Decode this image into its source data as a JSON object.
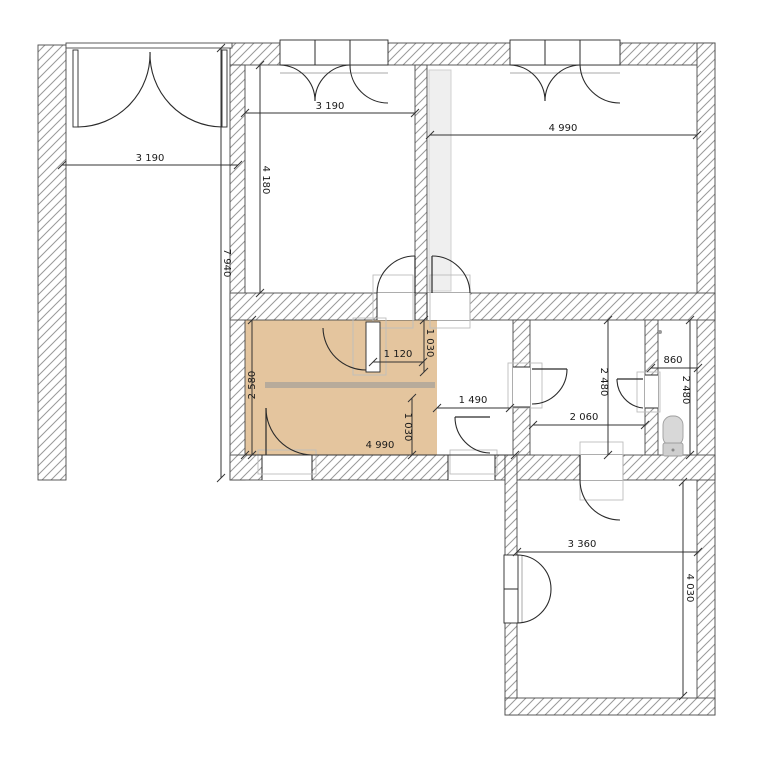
{
  "plan": {
    "canvas": {
      "width": 772,
      "height": 772
    },
    "colors": {
      "background": "#ffffff",
      "wall_border": "#4a4a4a",
      "hatch_line": "#999999",
      "line": "#2b2b2b",
      "highlight": "#e4c59e",
      "shelf": "#b7ab9b",
      "frame_gray": "#bdbdbd",
      "sill_gray": "#aaaaaa",
      "shaft_fill": "#efefef",
      "shaft_border": "#cccccc",
      "fixture_fill": "#d8d8d8",
      "fixture_fill2": "#cfcfcf",
      "fixture_border": "#9e9e9e",
      "dim_line": "#333333",
      "dim_text": "#1a1a1a"
    },
    "highlight_room": {
      "name": "highlighted-room-floor",
      "x": 245,
      "y": 320,
      "w": 192,
      "h": 135
    },
    "shaft": {
      "name": "duct-shaft",
      "x": 429,
      "y": 70,
      "w": 22,
      "h": 221
    },
    "shelf": {
      "name": "shelf-furniture",
      "x": 265,
      "y": 382,
      "w": 170,
      "h": 6
    },
    "walls": [
      {
        "name": "outbuilding-left-wall",
        "x": 38,
        "y": 45,
        "w": 28,
        "h": 435
      },
      {
        "name": "top-wall",
        "x": 230,
        "y": 43,
        "w": 485,
        "h": 22
      },
      {
        "name": "right-wall",
        "x": 697,
        "y": 43,
        "w": 18,
        "h": 672
      },
      {
        "name": "main-left-wall",
        "x": 230,
        "y": 65,
        "w": 15,
        "h": 415
      },
      {
        "name": "top-rooms-partition",
        "x": 415,
        "y": 65,
        "w": 12,
        "h": 228
      },
      {
        "name": "middle-wall",
        "x": 230,
        "y": 293,
        "w": 485,
        "h": 27
      },
      {
        "name": "hall-bath-wall",
        "x": 513,
        "y": 320,
        "w": 17,
        "h": 135
      },
      {
        "name": "bath-wc-wall",
        "x": 645,
        "y": 320,
        "w": 13,
        "h": 135
      },
      {
        "name": "middle-bottom-wall",
        "x": 230,
        "y": 455,
        "w": 285,
        "h": 25
      },
      {
        "name": "bottom-room-top-wall",
        "x": 505,
        "y": 455,
        "w": 210,
        "h": 25
      },
      {
        "name": "bottom-room-left-wall",
        "x": 505,
        "y": 455,
        "w": 12,
        "h": 260
      },
      {
        "name": "bottom-room-bottom-wall",
        "x": 505,
        "y": 698,
        "w": 210,
        "h": 17
      }
    ],
    "thin_walls": [
      {
        "name": "entry-lintel",
        "x": 66,
        "y": 43,
        "w": 166,
        "h": 5
      }
    ],
    "openings": [
      {
        "name": "door-opening-top-middle-room",
        "x": 377,
        "y": 293,
        "w": 38,
        "h": 27,
        "dir": "h"
      },
      {
        "name": "door-opening-top-right-room",
        "x": 427,
        "y": 293,
        "w": 43,
        "h": 27,
        "dir": "h"
      },
      {
        "name": "door-opening-bathroom",
        "x": 513,
        "y": 367,
        "w": 17,
        "h": 40,
        "dir": "v"
      },
      {
        "name": "door-opening-wc",
        "x": 645,
        "y": 375,
        "w": 13,
        "h": 33,
        "dir": "v"
      },
      {
        "name": "door-opening-highlight-room",
        "x": 262,
        "y": 455,
        "w": 50,
        "h": 25,
        "dir": "h"
      },
      {
        "name": "door-opening-hall",
        "x": 448,
        "y": 455,
        "w": 47,
        "h": 25,
        "dir": "h"
      },
      {
        "name": "door-opening-bottom-room",
        "x": 580,
        "y": 455,
        "w": 43,
        "h": 25,
        "dir": "h"
      }
    ],
    "windows": [
      {
        "name": "window-top-middle-room",
        "clear": [
          280,
          43,
          108,
          22
        ],
        "frame": [
          280,
          40,
          108,
          25
        ],
        "mullions": [
          [
            315,
            40,
            315,
            65
          ],
          [
            350,
            40,
            350,
            65
          ]
        ],
        "sill": [
          280,
          73,
          388,
          73
        ]
      },
      {
        "name": "window-top-right-room",
        "clear": [
          510,
          43,
          110,
          22
        ],
        "frame": [
          510,
          40,
          110,
          25
        ],
        "mullions": [
          [
            545,
            40,
            545,
            65
          ],
          [
            580,
            40,
            580,
            65
          ]
        ],
        "sill": [
          510,
          73,
          620,
          73
        ]
      },
      {
        "name": "window-bottom-room",
        "clear": [
          505,
          555,
          12,
          68
        ],
        "frame": [
          504,
          555,
          14,
          68
        ],
        "mullions": [
          [
            504,
            589,
            518,
            589
          ]
        ],
        "sill": [
          522,
          555,
          522,
          623
        ]
      }
    ],
    "door_leaf_rects": [
      {
        "name": "entry-door-left-leaf",
        "x": 73,
        "y": 50,
        "w": 5,
        "h": 77
      },
      {
        "name": "entry-door-right-leaf",
        "x": 222,
        "y": 50,
        "w": 5,
        "h": 77
      },
      {
        "name": "highlight-room-door-leaf",
        "x": 366,
        "y": 322,
        "w": 14,
        "h": 50
      }
    ],
    "door_leaf_lines": [
      {
        "name": "door-leaf",
        "x1": 415,
        "y1": 256,
        "x2": 415,
        "y2": 293
      },
      {
        "name": "door-leaf",
        "x1": 432,
        "y1": 256,
        "x2": 432,
        "y2": 293
      },
      {
        "name": "door-leaf",
        "x1": 266,
        "y1": 408,
        "x2": 266,
        "y2": 455
      },
      {
        "name": "door-leaf",
        "x1": 455,
        "y1": 417,
        "x2": 490,
        "y2": 417
      },
      {
        "name": "door-leaf",
        "x1": 532,
        "y1": 369,
        "x2": 567,
        "y2": 369
      },
      {
        "name": "door-leaf",
        "x1": 617,
        "y1": 379,
        "x2": 643,
        "y2": 379
      },
      {
        "name": "door-leaf",
        "x1": 580,
        "y1": 455,
        "x2": 580,
        "y2": 480
      }
    ],
    "arcs": [
      {
        "name": "entry-door-left-swing-arc",
        "d": "M 78 127 A 73 73 0 0 0 150 52"
      },
      {
        "name": "entry-door-right-swing-arc",
        "d": "M 222 127 A 73 73 0 0 1 150 52"
      },
      {
        "name": "window-casement-arc",
        "d": "M 280 65 A 36 36 0 0 1 315 101"
      },
      {
        "name": "window-casement-arc",
        "d": "M 350 65 A 36 36 0 0 0 315 101"
      },
      {
        "name": "window-casement-arc",
        "d": "M 350 65 A 38 38 0 0 0 388 103"
      },
      {
        "name": "window-casement-arc",
        "d": "M 510 65 A 36 36 0 0 1 545 101"
      },
      {
        "name": "window-casement-arc",
        "d": "M 580 65 A 36 36 0 0 0 545 101"
      },
      {
        "name": "window-casement-arc",
        "d": "M 580 65 A 40 40 0 0 0 620 103"
      },
      {
        "name": "door-swing-arc",
        "d": "M 415 256 A 38 38 0 0 0 377 293"
      },
      {
        "name": "door-swing-arc",
        "d": "M 432 256 A 38 38 0 0 1 470 293"
      },
      {
        "name": "door-swing-arc",
        "d": "M 366 370 A 43 43 0 0 1 323 328"
      },
      {
        "name": "door-swing-arc",
        "d": "M 266 408 A 47 47 0 0 0 312 455"
      },
      {
        "name": "door-swing-arc",
        "d": "M 455 417 A 36 36 0 0 0 490 453"
      },
      {
        "name": "door-swing-arc",
        "d": "M 567 369 A 35 35 0 0 1 532 404"
      },
      {
        "name": "door-swing-arc",
        "d": "M 617 379 A 29 29 0 0 0 643 408"
      },
      {
        "name": "door-swing-arc",
        "d": "M 580 480 A 40 40 0 0 0 620 520"
      },
      {
        "name": "window-casement-arc",
        "d": "M 517 555 A 34 34 0 0 1 551 589"
      },
      {
        "name": "window-casement-arc",
        "d": "M 517 623 A 34 34 0 0 0 551 589"
      }
    ],
    "frames": [
      {
        "name": "door-frame",
        "x": 373,
        "y": 275,
        "w": 40,
        "h": 53
      },
      {
        "name": "door-frame",
        "x": 430,
        "y": 275,
        "w": 40,
        "h": 53
      },
      {
        "name": "door-frame",
        "x": 353,
        "y": 318,
        "w": 33,
        "h": 57
      },
      {
        "name": "door-frame",
        "x": 258,
        "y": 450,
        "w": 58,
        "h": 24
      },
      {
        "name": "door-frame",
        "x": 450,
        "y": 450,
        "w": 47,
        "h": 24
      },
      {
        "name": "door-frame",
        "x": 508,
        "y": 363,
        "w": 34,
        "h": 45
      },
      {
        "name": "door-frame",
        "x": 637,
        "y": 372,
        "w": 23,
        "h": 40
      },
      {
        "name": "door-frame",
        "x": 580,
        "y": 442,
        "w": 43,
        "h": 58
      }
    ],
    "fixtures": {
      "toilet_bowl": {
        "name": "toilet-bowl",
        "x": 663,
        "y": 416,
        "w": 20,
        "h": 30,
        "rx": 9
      },
      "toilet_tank": {
        "name": "toilet-tank",
        "x": 663,
        "y": 443,
        "w": 20,
        "h": 13,
        "rx": 2
      },
      "tank_button": {
        "name": "toilet-flush-button",
        "cx": 673,
        "cy": 450,
        "r": 1.5
      },
      "floor_drain": {
        "name": "floor-drain-dot",
        "cx": 660,
        "cy": 332,
        "r": 2
      }
    },
    "dims": [
      {
        "label": "3 190",
        "line": [
          62,
          165,
          238,
          165
        ],
        "tx": 150,
        "ty": 161,
        "rot": 0
      },
      {
        "label": "7 940",
        "line": [
          221,
          48,
          221,
          478
        ],
        "tx": 224,
        "ty": 263,
        "rot": 90
      },
      {
        "label": "3 190",
        "line": [
          245,
          113,
          415,
          113
        ],
        "tx": 330,
        "ty": 109,
        "rot": 0
      },
      {
        "label": "4 180",
        "line": [
          260,
          65,
          260,
          293
        ],
        "tx": 263,
        "ty": 180,
        "rot": 90
      },
      {
        "label": "4 990",
        "line": [
          430,
          135,
          697,
          135
        ],
        "tx": 563,
        "ty": 131,
        "rot": 0
      },
      {
        "label": "2 580",
        "line": [
          252,
          320,
          252,
          455
        ],
        "tx": 255,
        "ty": 385,
        "rot": -90
      },
      {
        "label": "1 120",
        "line": [
          373,
          362,
          423,
          362
        ],
        "tx": 398,
        "ty": 357,
        "rot": 0
      },
      {
        "label": "1 030",
        "line": [
          424,
          320,
          424,
          372
        ],
        "tx": 427,
        "ty": 343,
        "rot": 90
      },
      {
        "label": "1 030",
        "line": [
          412,
          398,
          412,
          455
        ],
        "tx": 405,
        "ty": 427,
        "rot": 90
      },
      {
        "label": "4 990",
        "line": [
          245,
          455,
          515,
          455
        ],
        "tx": 380,
        "ty": 448,
        "rot": 0
      },
      {
        "label": "1 490",
        "line": [
          437,
          408,
          510,
          408
        ],
        "tx": 473,
        "ty": 403,
        "rot": 0
      },
      {
        "label": "2 060",
        "line": [
          533,
          425,
          645,
          425
        ],
        "tx": 584,
        "ty": 420,
        "rot": 0
      },
      {
        "label": "2 480",
        "line": [
          608,
          320,
          608,
          455
        ],
        "tx": 601,
        "ty": 382,
        "rot": 90
      },
      {
        "label": "860",
        "line": [
          651,
          368,
          698,
          368
        ],
        "tx": 673,
        "ty": 363,
        "rot": 0
      },
      {
        "label": "2 480",
        "line": [
          690,
          320,
          690,
          455
        ],
        "tx": 683,
        "ty": 390,
        "rot": 90
      },
      {
        "label": "3 360",
        "line": [
          517,
          552,
          698,
          552
        ],
        "tx": 582,
        "ty": 547,
        "rot": 0
      },
      {
        "label": "4 030",
        "line": [
          683,
          482,
          683,
          696
        ],
        "tx": 687,
        "ty": 588,
        "rot": 90
      }
    ]
  }
}
